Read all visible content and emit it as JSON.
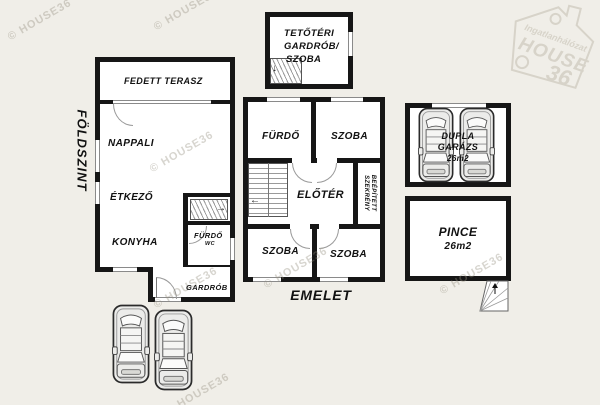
{
  "meta": {
    "type": "floor-plan",
    "brand": "HOUSE36"
  },
  "palette": {
    "background": "#f0eee8",
    "wall": "#161616",
    "room_fill": "#ffffff",
    "text": "#111111",
    "watermark": "#969080"
  },
  "watermark": {
    "copyright": "© HOUSE36",
    "logo_top": "Ingatlanhálózat",
    "logo_main": "HOUSE",
    "logo_number": "36"
  },
  "icons": {
    "arrow_right": "→",
    "arrow_left": "←",
    "arrow_down": "↓",
    "arrow_up": "↑"
  },
  "ground_floor": {
    "title": "FÖLDSZINT",
    "terrace": "FEDETT TERASZ",
    "living_room": "NAPPALI",
    "dining_room": "ÉTKEZŐ",
    "kitchen": "KONYHA",
    "bathroom": "FÜRDŐ",
    "wc": "WC",
    "wardrobe": "GARDRÓB"
  },
  "attic": {
    "line1": "TETŐTÉRI",
    "line2": "GARDRÓB/",
    "line3": "SZOBA"
  },
  "upper_floor": {
    "title": "EMELET",
    "bathroom": "FÜRDŐ",
    "room_top": "SZOBA",
    "hall": "ELŐTÉR",
    "closet_line1": "BEÉPÍTETT",
    "closet_line2": "SZEKRÉNY",
    "room_left": "SZOBA",
    "room_right": "SZOBA"
  },
  "garage": {
    "line1": "DUPLA",
    "line2": "GARÁZS",
    "area": "26m2"
  },
  "basement": {
    "name": "PINCE",
    "area": "26m2"
  }
}
